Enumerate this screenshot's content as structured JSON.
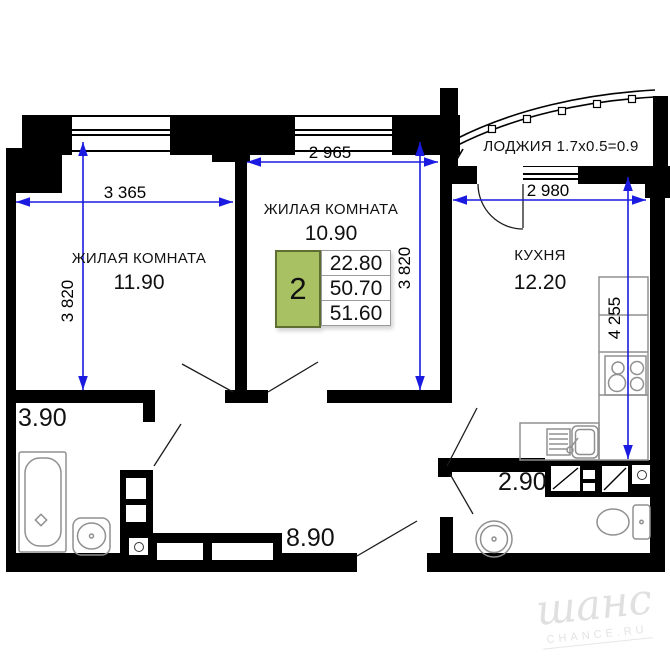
{
  "rooms": {
    "room1": {
      "name": "ЖИЛАЯ КОМНАТА",
      "area": "11.90"
    },
    "room2": {
      "name": "ЖИЛАЯ КОМНАТА",
      "area": "10.90"
    },
    "kitchen": {
      "name": "КУХНЯ",
      "area": "12.20"
    },
    "loggia": {
      "label": "ЛОДЖИЯ 1.7x0.5=0.9"
    },
    "bathroom": {
      "area": "3.90"
    },
    "hallway": {
      "area": "8.90"
    },
    "wc": {
      "area": "2.90"
    }
  },
  "dimensions": {
    "room1_width": "3 365",
    "room1_depth": "3 820",
    "room2_width": "2 965",
    "room2_depth": "3 820",
    "kitchen_width": "2 980",
    "kitchen_depth": "4 255"
  },
  "info_table": {
    "rooms_count": "2",
    "living_area": "22.80",
    "area_without_loggia": "50.70",
    "total_area": "51.60"
  },
  "watermark": {
    "logo": "шанс",
    "site": "CHANCE.RU"
  },
  "colors": {
    "wall": "#000000",
    "dimension_line": "#1a1ae0",
    "info_green": "#a8c163",
    "fixture": "#909090"
  }
}
